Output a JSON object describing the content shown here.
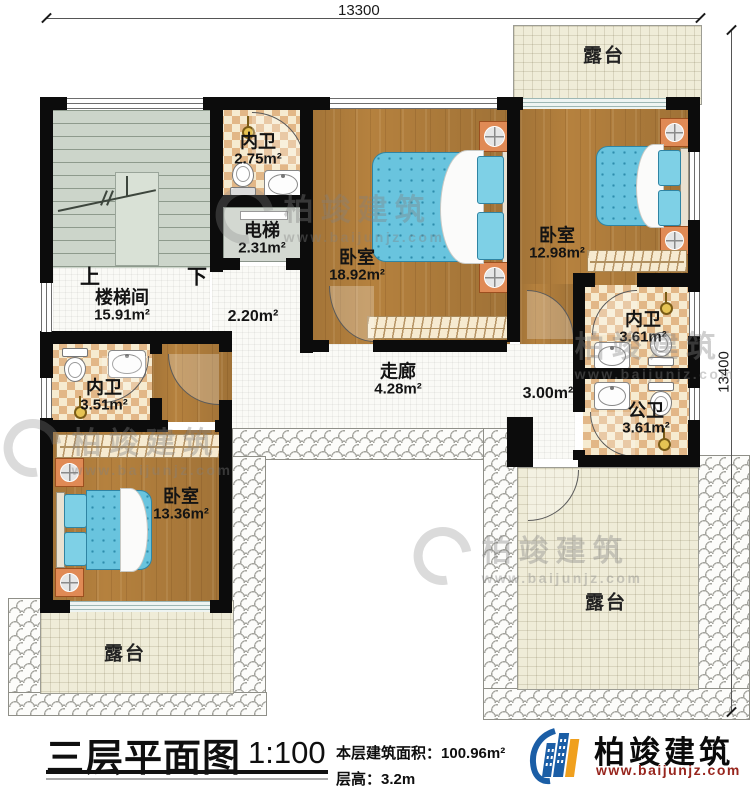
{
  "dimensions": {
    "top": "13300",
    "right": "13400"
  },
  "rooms": {
    "terrace_tr": {
      "name": "露台"
    },
    "stairwell": {
      "name": "楼梯间",
      "area": "15.91m²",
      "up": "上",
      "down": "下"
    },
    "bath_top": {
      "name": "内卫",
      "area": "2.75m²"
    },
    "elevator": {
      "name": "电梯",
      "area": "2.31m²"
    },
    "hall_small": {
      "area": "2.20m²"
    },
    "bedroom_master": {
      "name": "卧室",
      "area": "18.92m²"
    },
    "bedroom_right": {
      "name": "卧室",
      "area": "12.98m²"
    },
    "bath_right": {
      "name": "内卫",
      "area": "3.61m²"
    },
    "bath_public": {
      "name": "公卫",
      "area": "3.61m²"
    },
    "hall_right": {
      "area": "3.00m²"
    },
    "corridor": {
      "name": "走廊",
      "area": "4.28m²"
    },
    "bath_left": {
      "name": "内卫",
      "area": "3.51m²"
    },
    "bedroom_left": {
      "name": "卧室",
      "area": "13.36m²"
    },
    "terrace_bl": {
      "name": "露台"
    },
    "terrace_br": {
      "name": "露台"
    }
  },
  "title_block": {
    "title": "三层平面图",
    "scale": "1:100",
    "area_label": "本层建筑面积：",
    "area_value": "100.96m²",
    "height_label": "层高：",
    "height_value": "3.2m"
  },
  "logo": {
    "name": "柏竣建筑",
    "url": "www.baijunjz.com"
  },
  "watermark": {
    "name": "柏竣建筑",
    "url": "www.baijunjz.com"
  },
  "colors": {
    "wall": "#0c0c0c",
    "wood": "#b5813e",
    "tile": "#e2b787",
    "bed": "#69c4de",
    "terrace": "#efecd8",
    "logo_blue": "#1b5ea6",
    "logo_orange": "#f0a01e",
    "url_red": "#97251d"
  }
}
